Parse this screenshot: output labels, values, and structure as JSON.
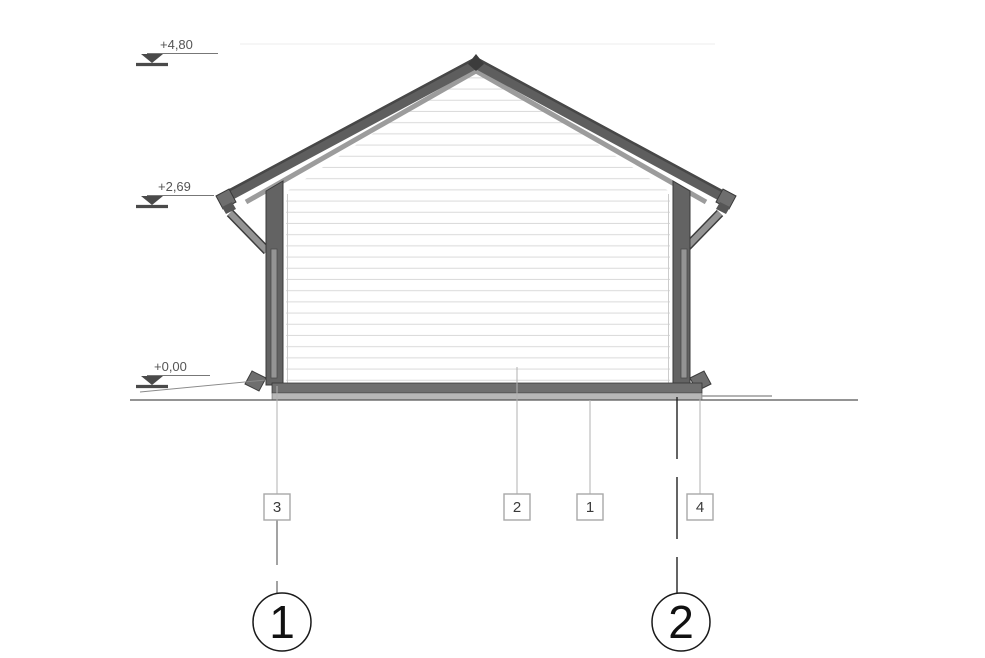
{
  "section": {
    "elevations": [
      {
        "label": "+4,80"
      },
      {
        "label": "+2,69"
      },
      {
        "label": "+0,00"
      }
    ],
    "callouts": [
      {
        "label": "3"
      },
      {
        "label": "2"
      },
      {
        "label": "1"
      },
      {
        "label": "4"
      }
    ],
    "grid_axes": [
      {
        "label": "1"
      },
      {
        "label": "2"
      }
    ],
    "colors": {
      "roof_band": "#5e5e5e",
      "roof_top_edge": "#474747",
      "roof_underside": "#9c9c9c",
      "wall": "#636363",
      "gutter_pipe": "#949494",
      "slab_upper": "#6f6f6f",
      "slab_lower": "#b7b7b7",
      "siding_line": "#dcdcdc",
      "annotation_gray": "#555555",
      "leader_gray": "#b0b0b0",
      "background": "#ffffff"
    }
  }
}
